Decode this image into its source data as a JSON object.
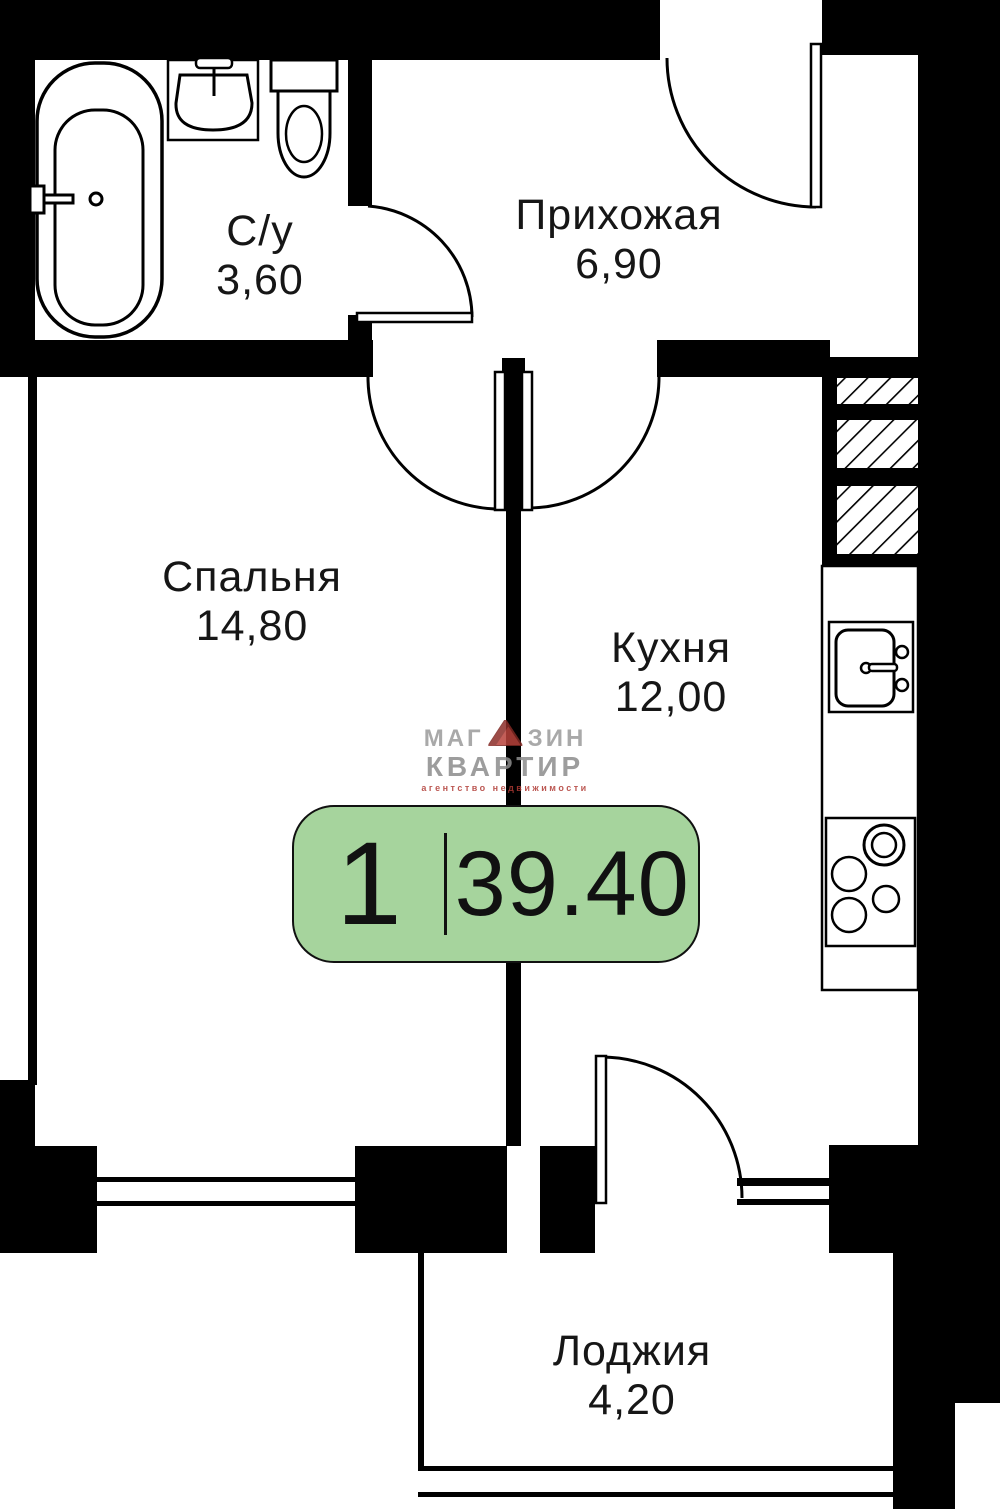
{
  "plan": {
    "title": "1-room apartment floor plan",
    "rooms": [
      {
        "id": "bathroom",
        "name": "С/у",
        "area": "3,60"
      },
      {
        "id": "hallway",
        "name": "Прихожая",
        "area": "6,90"
      },
      {
        "id": "bedroom",
        "name": "Спальня",
        "area": "14,80"
      },
      {
        "id": "kitchen",
        "name": "Кухня",
        "area": "12,00"
      },
      {
        "id": "loggia",
        "name": "Лоджия",
        "area": "4,20"
      }
    ],
    "badge": {
      "rooms_count": "1",
      "total_area": "39.40",
      "background_color": "#a6d49d",
      "border_color": "#111111"
    },
    "logo": {
      "line1_left": "МАГ",
      "line1_right": "ЗИН",
      "line2": "КВАРТИР",
      "tagline": "агентство недвижимости",
      "triangle_color": "#b8423b",
      "triangle_edge_color": "#7e2823",
      "text_color": "#9b9b9b",
      "tagline_color": "#b03a34"
    },
    "colors": {
      "walls": "#000000",
      "background": "#ffffff"
    }
  }
}
